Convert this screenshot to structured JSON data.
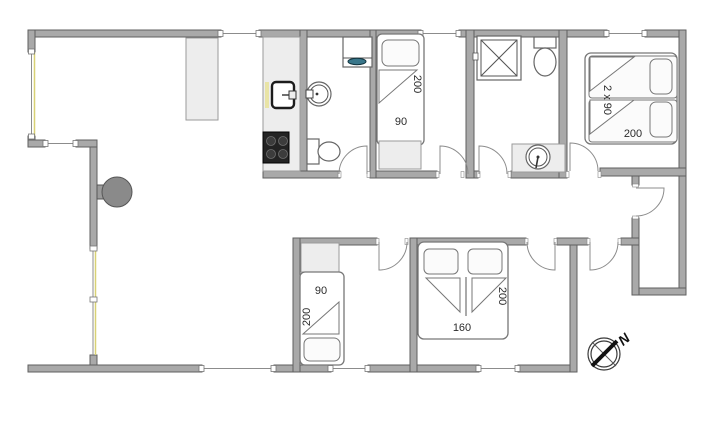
{
  "floorplan": {
    "beds": {
      "top_single": {
        "length": "200",
        "width": "90"
      },
      "master_double": {
        "width_label": "2 x 90",
        "length": "200"
      },
      "bottom_single": {
        "width": "90",
        "length": "200"
      },
      "bottom_double": {
        "length": "200",
        "width": "160"
      }
    },
    "compass": {
      "north_label": "N"
    },
    "colors": {
      "wall": "#a9a9a9",
      "wall_outline": "#5f5f5f",
      "fixture_outline": "#666666",
      "cabinet_fill": "#ededed",
      "stove": "#232323",
      "fireplace": "#8a8a8a",
      "washer_door": "#39768a",
      "window_glass": "#d8d175"
    }
  }
}
